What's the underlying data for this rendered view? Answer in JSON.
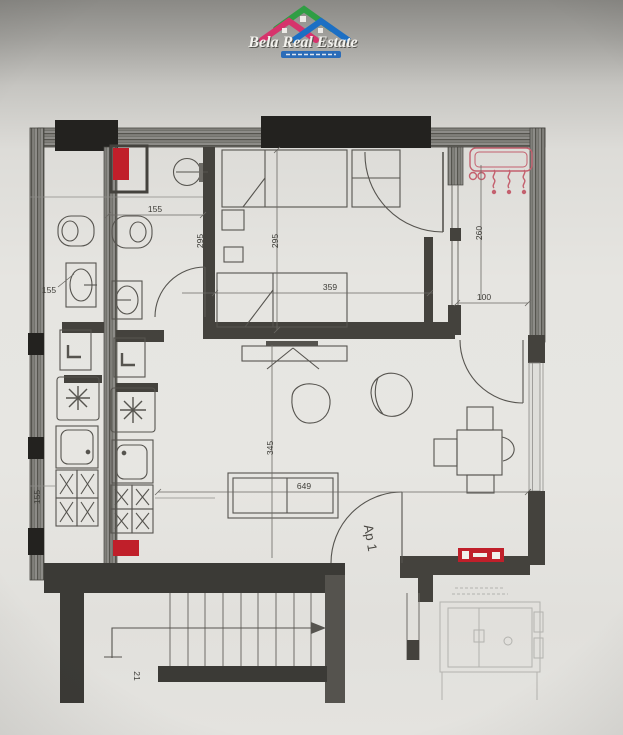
{
  "logo": {
    "title": "Bela Real Estate",
    "roof_left_color": "#d6336c",
    "roof_mid_color": "#2f9e44",
    "roof_right_color": "#1c6fc4",
    "banner_color": "#2b6cb8"
  },
  "plan": {
    "apartment_label": "Ap 1",
    "stair_label": "21",
    "dims": {
      "bathroom_width": "155",
      "bathroom_callout": "155",
      "left_edge": "155",
      "bathroom_depth": "295",
      "bedroom_depth": "295",
      "bedroom_width": "359",
      "balcony_depth": "260",
      "balcony_width": "100",
      "living_depth": "345",
      "living_width": "649"
    },
    "colors": {
      "shaft_red": "#c01f2a",
      "panel_red": "#c01f2a",
      "ac_pink": "#c4606e",
      "wall_dark": "#44423d",
      "wall_black": "#23221f",
      "line": "#56544f"
    }
  }
}
